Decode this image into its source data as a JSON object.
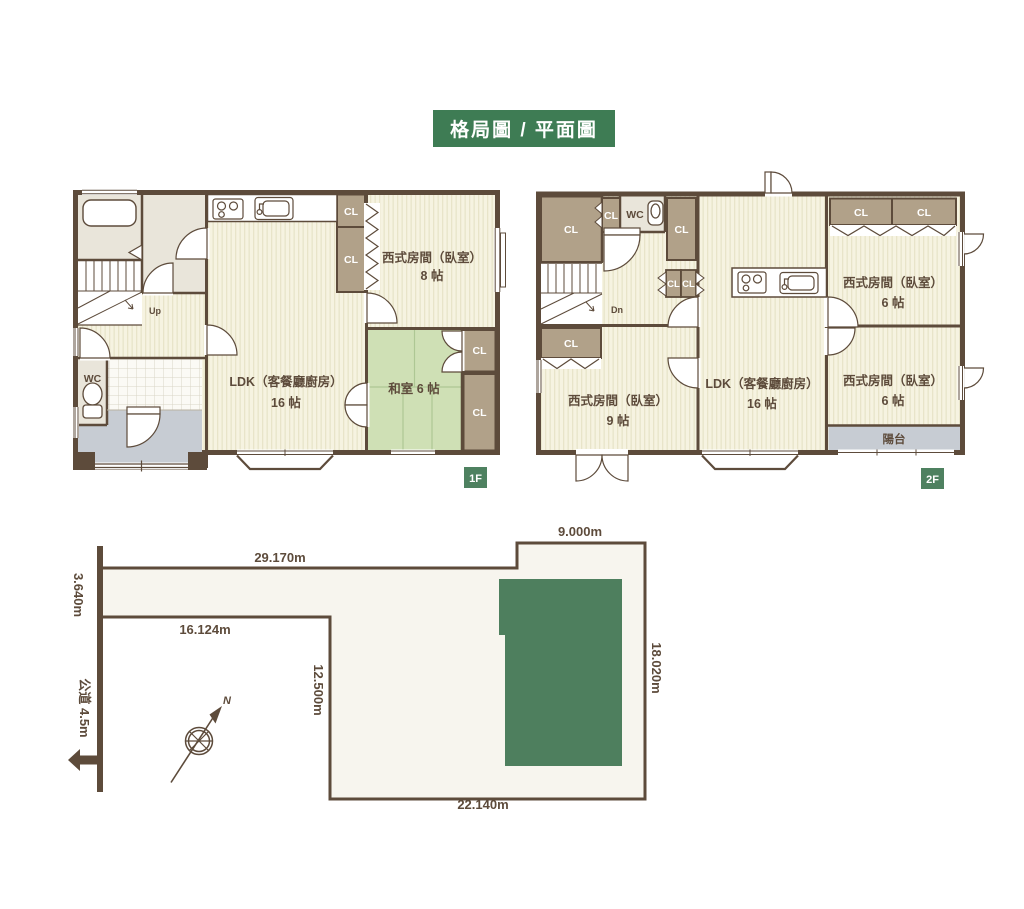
{
  "title": "格局圖 / 平面圖",
  "labels": {
    "cl": "CL",
    "wc": "WC",
    "up": "Up",
    "dn": "Dn"
  },
  "floor1": {
    "badge": "1F",
    "ldk": {
      "name": "LDK（客餐廳廚房）",
      "size": "16 帖"
    },
    "western8": {
      "name": "西式房間（臥室）",
      "size": "8 帖"
    },
    "washitsu": "和室 6 帖"
  },
  "floor2": {
    "badge": "2F",
    "ldk": {
      "name": "LDK（客餐廳廚房）",
      "size": "16 帖"
    },
    "western9": {
      "name": "西式房間（臥室）",
      "size": "9 帖"
    },
    "western6_top": {
      "name": "西式房間（臥室）",
      "size": "6 帖"
    },
    "western6_bottom": {
      "name": "西式房間（臥室）",
      "size": "6 帖"
    },
    "balcony": "陽台"
  },
  "site": {
    "north": "N",
    "dim_top": "29.170m",
    "dim_top_right": "9.000m",
    "dim_left": "3.640m",
    "dim_inner_h": "16.124m",
    "dim_inner_v": "12.500m",
    "dim_right": "18.020m",
    "dim_bottom": "22.140m",
    "road": "公道 4.5m"
  },
  "colors": {
    "accent_green": "#3e7c54",
    "badge_green": "#4e8160",
    "building_green": "#4e7f5e",
    "wall_brown": "#5d4b3b",
    "closet_brown": "#b1a189",
    "tatami_green": "#cfe0b5",
    "floor_cream": "#f6f3e1",
    "service_gray": "#e9e5da",
    "entry_gray": "#c7ccd3",
    "site_fill": "#f7f5ee"
  }
}
